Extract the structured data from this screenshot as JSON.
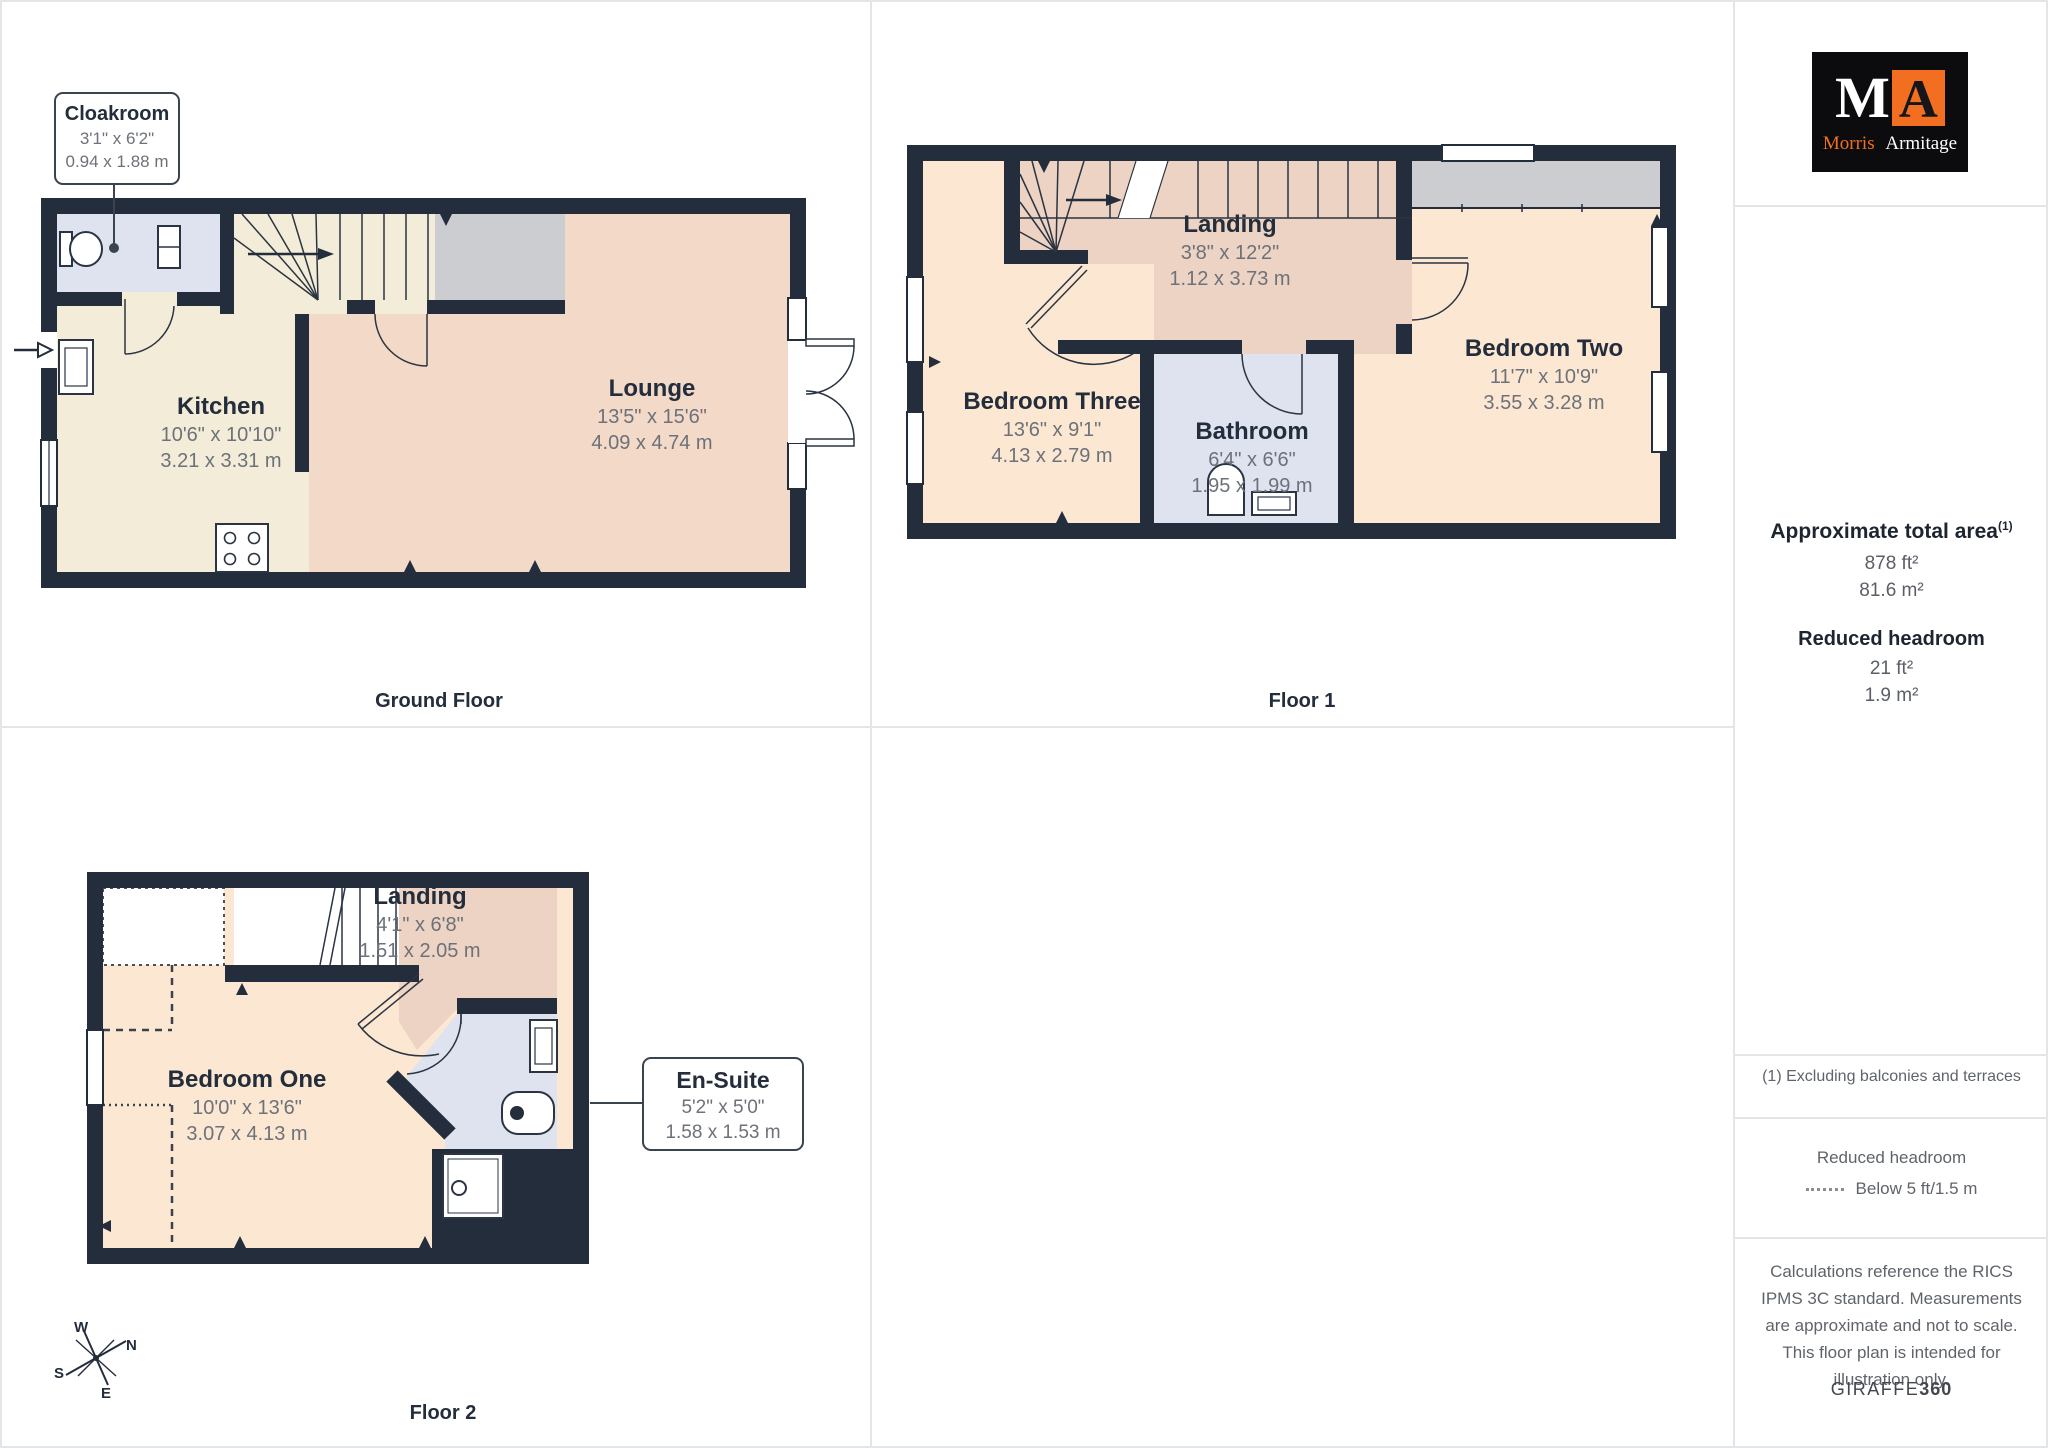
{
  "branding": {
    "logo_m": "M",
    "logo_a": "A",
    "name_first": "Morris",
    "name_last": "Armitage"
  },
  "floors": [
    {
      "caption": "Ground Floor",
      "rooms": [
        {
          "name": "Cloakroom",
          "imperial": "3'1\" x 6'2\"",
          "metric": "0.94 x 1.88 m"
        },
        {
          "name": "Kitchen",
          "imperial": "10'6\" x 10'10\"",
          "metric": "3.21 x 3.31 m"
        },
        {
          "name": "Lounge",
          "imperial": "13'5\" x 15'6\"",
          "metric": "4.09 x 4.74 m"
        }
      ]
    },
    {
      "caption": "Floor 1",
      "rooms": [
        {
          "name": "Landing",
          "imperial": "3'8\" x 12'2\"",
          "metric": "1.12 x 3.73 m"
        },
        {
          "name": "Bedroom Three",
          "imperial": "13'6\" x 9'1\"",
          "metric": "4.13 x 2.79 m"
        },
        {
          "name": "Bathroom",
          "imperial": "6'4\" x 6'6\"",
          "metric": "1.95 x 1.99 m"
        },
        {
          "name": "Bedroom Two",
          "imperial": "11'7\" x 10'9\"",
          "metric": "3.55 x 3.28 m"
        }
      ]
    },
    {
      "caption": "Floor 2",
      "rooms": [
        {
          "name": "Bedroom One",
          "imperial": "10'0\" x 13'6\"",
          "metric": "3.07 x 4.13 m"
        },
        {
          "name": "Landing",
          "imperial": "4'1\" x 6'8\"",
          "metric": "1.51 x 2.05 m"
        },
        {
          "name": "En-Suite",
          "imperial": "5'2\" x 5'0\"",
          "metric": "1.58 x 1.53 m"
        }
      ]
    }
  ],
  "sidebar": {
    "total_area": {
      "label": "Approximate total area",
      "footnote_marker": "(1)",
      "imperial": "878 ft²",
      "metric": "81.6 m²"
    },
    "reduced_headroom": {
      "label": "Reduced headroom",
      "imperial": "21 ft²",
      "metric": "1.9 m²"
    },
    "footnote": "(1) Excluding balconies and terraces",
    "legend": {
      "title": "Reduced headroom",
      "item": "Below 5 ft/1.5 m"
    },
    "disclaimer": "Calculations reference the RICS IPMS 3C standard. Measurements are approximate and not to scale. This floor plan is intended for illustration only.",
    "provider": {
      "name": "GIRAFFE",
      "suffix": "360"
    }
  },
  "compass": {
    "n": "N",
    "e": "E",
    "s": "S",
    "w": "W"
  },
  "colors": {
    "wall": "#232d3b",
    "kitchen_floor": "#f3ecd8",
    "lounge_floor": "#f2d9c8",
    "bedroom_floor": "#fce8d2",
    "landing_floor": "#edd3c3",
    "bathroom_floor": "#dfe3f0",
    "wardrobe_grey": "#cbcdd1",
    "brand_orange": "#f26f21",
    "dim_text": "#6d7179",
    "title_text": "#232d3b"
  }
}
